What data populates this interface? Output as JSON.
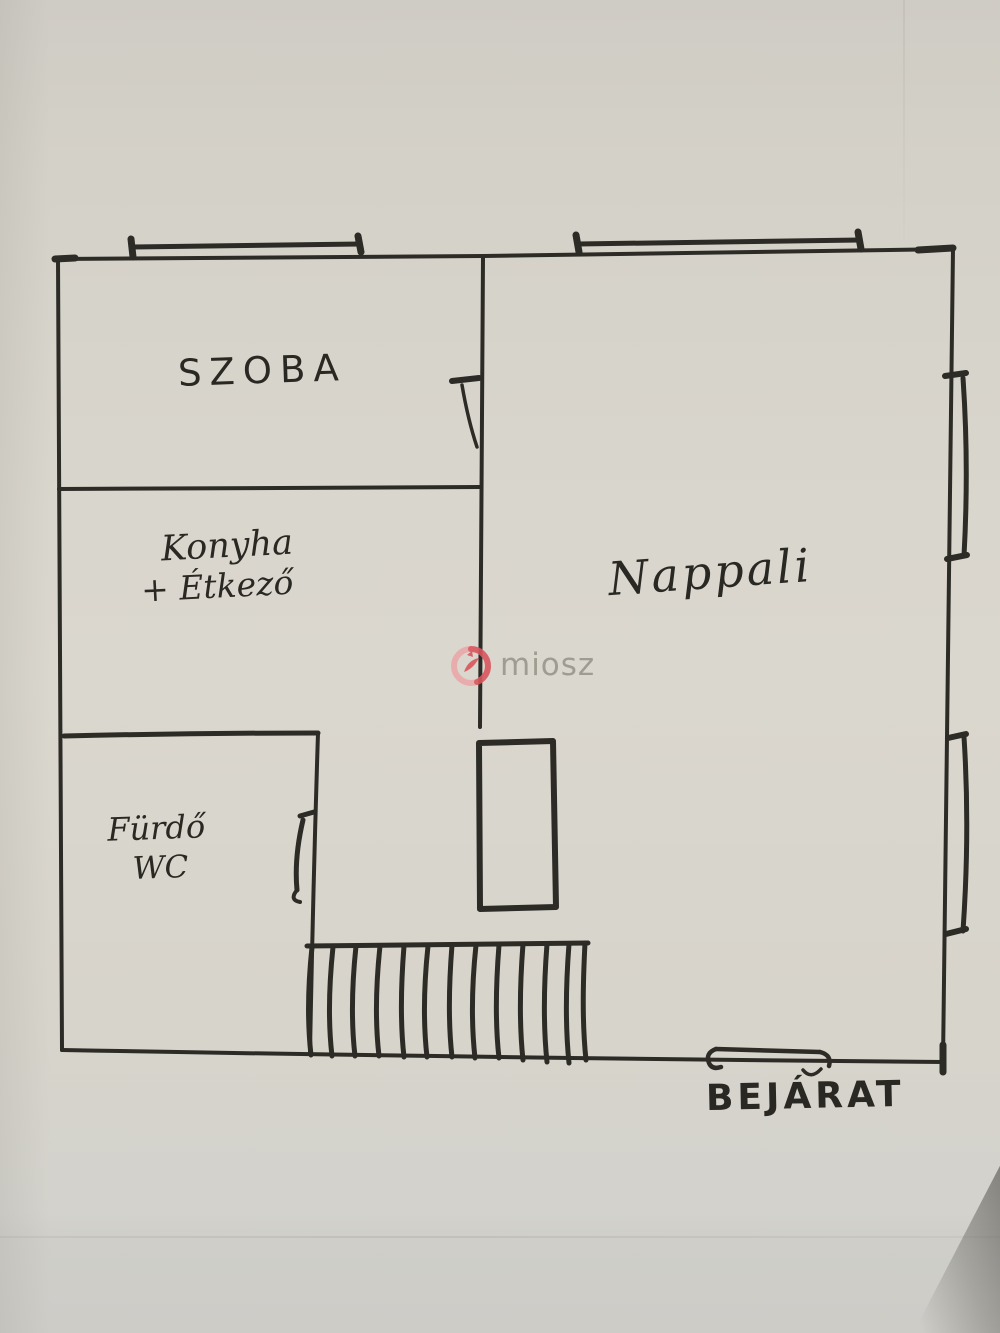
{
  "floorplan": {
    "rooms": {
      "szoba": {
        "label": "SZOBA"
      },
      "konyha": {
        "line1": "Konyha",
        "line2": "+ Étkező"
      },
      "furdo": {
        "line1": "Fürdő",
        "line2": "WC"
      },
      "nappali": {
        "label": "Nappali"
      },
      "entrance": {
        "label": "BEJÁRAT"
      }
    },
    "watermark": {
      "text": "miosz",
      "logo_color": "#d9565e",
      "logo_color_light": "#eda3a6",
      "text_color": "#8e8b81"
    },
    "colors": {
      "ink": "#2d2b26",
      "paper": "#d6d3ca"
    }
  }
}
